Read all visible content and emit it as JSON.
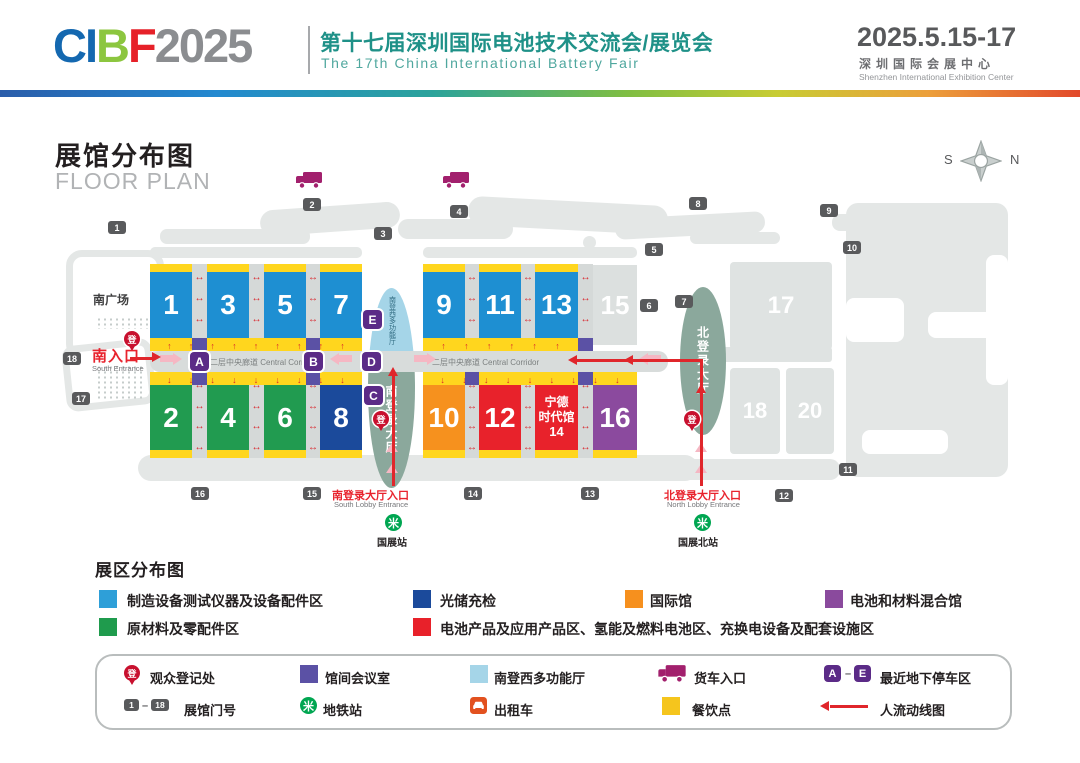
{
  "header": {
    "logo_letters": [
      "C",
      "I",
      "B",
      "F"
    ],
    "logo_year": "2025",
    "title_cn": "第十七届深圳国际电池技术交流会/展览会",
    "title_en": "The 17th China International Battery Fair",
    "dates": "2025.5.15-17",
    "venue_cn": "深圳国际会展中心",
    "venue_en": "Shenzhen International Exhibition Center"
  },
  "plan": {
    "title_cn": "展馆分布图",
    "title_en": "FLOOR PLAN",
    "compass_s": "S",
    "compass_n": "N",
    "south_plaza": "南广场",
    "south_entrance_cn": "南入口",
    "south_entrance_en": "South Entrance",
    "corridor_label": "二层中央廊道 Central Corridor",
    "south_lobby": "南登录大厅",
    "south_multi_hall": "南登西多功能厅",
    "north_lobby": "北登录大厅",
    "south_lobby_entrance_cn": "南登录大厅入口",
    "south_lobby_entrance_en": "South Lobby Entrance",
    "north_lobby_entrance_cn": "北登录大厅入口",
    "north_lobby_entrance_en": "North Lobby Entrance",
    "metro_south": "国展站",
    "metro_north": "国展北站",
    "reg_char": "登",
    "halls": {
      "h1": "1",
      "h2": "2",
      "h3": "3",
      "h4": "4",
      "h5": "5",
      "h6": "6",
      "h7": "7",
      "h8": "8",
      "h9": "9",
      "h10": "10",
      "h11": "11",
      "h12": "12",
      "h13": "13",
      "h15": "15",
      "h16": "16",
      "h17": "17",
      "h18": "18",
      "h20": "20"
    },
    "hall14": {
      "line1": "宁德",
      "line2": "时代馆",
      "line3": "14"
    },
    "gates": [
      "1",
      "2",
      "3",
      "4",
      "5",
      "6",
      "7",
      "8",
      "9",
      "10",
      "11",
      "12",
      "13",
      "14",
      "15",
      "16",
      "17",
      "18"
    ],
    "letters": [
      "A",
      "B",
      "C",
      "D",
      "E"
    ],
    "range_sep": "–"
  },
  "zones_legend": {
    "title": "展区分布图",
    "items": [
      {
        "color": "#2E9FD8",
        "label": "制造设备测试仪器及设备配件区"
      },
      {
        "color": "#1F9B4D",
        "label": "原材料及零配件区"
      },
      {
        "color": "#1B4A9B",
        "label": "光储充检"
      },
      {
        "color": "#E8212A",
        "label": "电池产品及应用产品区、氢能及燃料电池区、充换电设备及配套设施区"
      },
      {
        "color": "#F6901E",
        "label": "国际馆"
      },
      {
        "color": "#8A4A9D",
        "label": "电池和材料混合馆"
      }
    ]
  },
  "facilities_legend": {
    "reg": "观众登记处",
    "meeting": "馆间会议室",
    "multi": "南登西多功能厅",
    "truck": "货车入口",
    "parking": "最近地下停车区",
    "gate_no": "展馆门号",
    "metro": "地铁站",
    "taxi": "出租车",
    "dining": "餐饮点",
    "flow": "人流动线图"
  },
  "colors": {
    "hall_blue": "#1E8FD2",
    "hall_green": "#219B50",
    "hall_darkblue": "#1B4A9B",
    "hall_orange": "#F6911E",
    "hall_red": "#E8222B",
    "hall_purple": "#8B4A9E",
    "dining_yellow": "#FFD61E",
    "meeting_indigo": "#5B51A5",
    "multi_lightblue": "#A5D5E8",
    "lobby_sage": "#8BA89C",
    "truck_magenta": "#A2206D",
    "letter_purple": "#5B2B87",
    "gate_gray": "#595A5C",
    "reg_red": "#C8102E",
    "metro_green": "#00A651",
    "taxi_orange": "#E2511F",
    "flow_red": "#E0262B"
  }
}
